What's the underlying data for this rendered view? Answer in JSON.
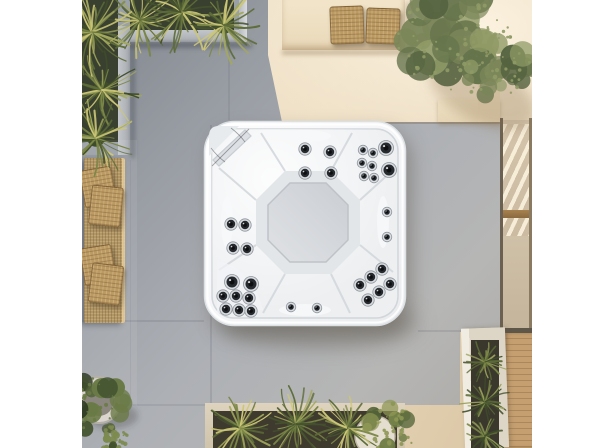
{
  "meta": {
    "alt": "Aerial top-down 3D render of a white square hot tub with chrome massage jets and a grey octagonal footwell, set on large grey concrete patio tiles; around it are concrete planters with spiky yucca plants, an olive tree in a pot on a sunlit cream floor, a long wicker bench with cushions, a cream bench with two wicker pillows, a glass door and a narrow wooden deck with a white trough planter.",
    "scene_type": "outdoor patio with hot tub, photographed from directly above"
  },
  "palette": {
    "paper_white": "#ffffff",
    "gray_tile": "#a7abb1",
    "gray_tile_dark": "#82878f",
    "cream_floor": "#ead9bf",
    "cream_light": "#f6ecd9",
    "bench_cream": "#eee0c4",
    "wicker": "#b29766",
    "cushion_tan": "#bb9a64",
    "wood_deck": "#c59f70",
    "door_frame": "#6b6152",
    "soil_dark": "#39402f",
    "plant_dark": "#45522e",
    "plant_light": "#ccc678",
    "olive_green": "#76815a",
    "tub_shell": "#f8f9fa",
    "tub_footwell": "#d3d6da",
    "jet_dark": "#26292e",
    "chrome_ring": "#d8dce0",
    "pot_white": "#ddd9d0"
  },
  "objects": [
    {
      "name": "hot-tub",
      "label": "white square hot tub with jets, empty, seen from above"
    },
    {
      "name": "footwell",
      "label": "octagonal grey footwell in tub centre"
    },
    {
      "name": "corner-step",
      "label": "diagonal corner step with skimmer in top-left of tub"
    },
    {
      "name": "top-left-planter",
      "label": "L-shaped concrete planter with spiky yucca plants"
    },
    {
      "name": "wicker-bench-left",
      "label": "long wicker bench with four tan cushions"
    },
    {
      "name": "top-bench",
      "label": "cream concrete bench with two wicker pillows"
    },
    {
      "name": "olive-tree",
      "label": "potted olive tree casting a soft shadow"
    },
    {
      "name": "glass-door",
      "label": "glass door with wooden frame reflecting sunlight"
    },
    {
      "name": "wooden-deck",
      "label": "narrow plank deck along right edge"
    },
    {
      "name": "white-trough-planter",
      "label": "white rectangular planter with green grasses"
    },
    {
      "name": "bottom-planter",
      "label": "long concrete planter with yuccas and a round pot"
    },
    {
      "name": "round-pot",
      "label": "round white pot with dark green shrub, bottom left"
    }
  ],
  "hot_tub": {
    "jet_sizes": {
      "s": 2.8,
      "m": 4.2,
      "l": 5.5
    },
    "jets": [
      {
        "x": 102,
        "y": 29,
        "s": "m"
      },
      {
        "x": 102,
        "y": 53,
        "s": "m"
      },
      {
        "x": 127,
        "y": 32,
        "s": "m"
      },
      {
        "x": 128,
        "y": 53,
        "s": "m"
      },
      {
        "x": 160,
        "y": 30,
        "s": "s"
      },
      {
        "x": 170,
        "y": 33,
        "s": "s"
      },
      {
        "x": 159,
        "y": 43,
        "s": "s"
      },
      {
        "x": 169,
        "y": 46,
        "s": "s"
      },
      {
        "x": 161,
        "y": 56,
        "s": "s"
      },
      {
        "x": 171,
        "y": 58,
        "s": "s"
      },
      {
        "x": 183,
        "y": 28,
        "s": "l"
      },
      {
        "x": 186,
        "y": 50,
        "s": "l"
      },
      {
        "x": 184,
        "y": 92,
        "s": "s"
      },
      {
        "x": 184,
        "y": 117,
        "s": "s"
      },
      {
        "x": 28,
        "y": 104,
        "s": "m"
      },
      {
        "x": 42,
        "y": 105,
        "s": "m"
      },
      {
        "x": 30,
        "y": 128,
        "s": "m"
      },
      {
        "x": 44,
        "y": 129,
        "s": "m"
      },
      {
        "x": 29,
        "y": 162,
        "s": "l"
      },
      {
        "x": 48,
        "y": 164,
        "s": "l"
      },
      {
        "x": 20,
        "y": 176,
        "s": "m"
      },
      {
        "x": 33,
        "y": 176,
        "s": "m"
      },
      {
        "x": 46,
        "y": 178,
        "s": "m"
      },
      {
        "x": 23,
        "y": 189,
        "s": "m"
      },
      {
        "x": 36,
        "y": 190,
        "s": "m"
      },
      {
        "x": 48,
        "y": 191,
        "s": "m"
      },
      {
        "x": 88,
        "y": 187,
        "s": "s"
      },
      {
        "x": 114,
        "y": 188,
        "s": "s"
      },
      {
        "x": 157,
        "y": 165,
        "s": "m"
      },
      {
        "x": 168,
        "y": 157,
        "s": "m"
      },
      {
        "x": 179,
        "y": 149,
        "s": "m"
      },
      {
        "x": 165,
        "y": 180,
        "s": "m"
      },
      {
        "x": 176,
        "y": 172,
        "s": "m"
      },
      {
        "x": 187,
        "y": 164,
        "s": "m"
      }
    ]
  }
}
